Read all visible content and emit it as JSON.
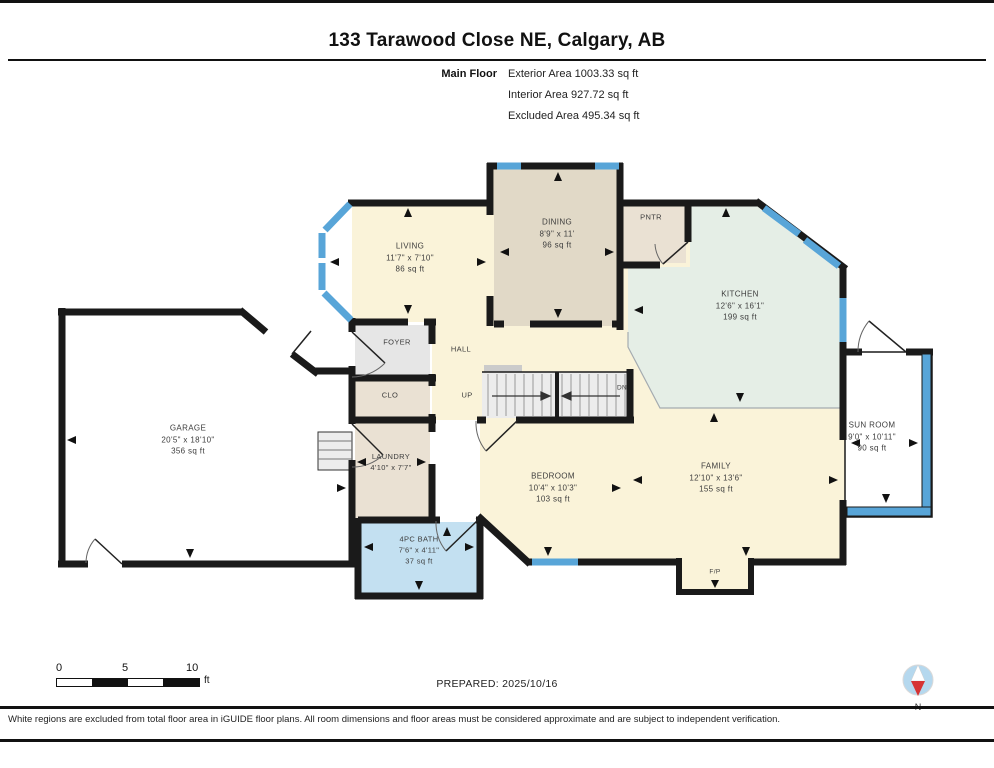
{
  "page": {
    "title": "133 Tarawood Close NE, Calgary, AB",
    "floor_label": "Main Floor",
    "stats": [
      {
        "label": "Exterior Area",
        "value": "1003.33 sq ft"
      },
      {
        "label": "Interior Area",
        "value": "927.72 sq ft"
      },
      {
        "label": "Excluded Area",
        "value": "495.34 sq ft"
      }
    ]
  },
  "rooms": {
    "living": {
      "name": "LIVING",
      "dims": "11'7\" x 7'10\"",
      "area": "86 sq ft"
    },
    "dining": {
      "name": "DINING",
      "dims": "8'9\" x 11'",
      "area": "96 sq ft"
    },
    "pantry": {
      "name": "PNTR"
    },
    "kitchen": {
      "name": "KITCHEN",
      "dims": "12'6\" x 16'1\"",
      "area": "199 sq ft"
    },
    "foyer": {
      "name": "FOYER"
    },
    "hall": {
      "name": "HALL"
    },
    "closet": {
      "name": "CLO"
    },
    "laundry": {
      "name": "LAUNDRY",
      "dims": "4'10\" x 7'7\""
    },
    "garage": {
      "name": "GARAGE",
      "dims": "20'5\" x 18'10\"",
      "area": "356 sq ft"
    },
    "bedroom": {
      "name": "BEDROOM",
      "dims": "10'4\" x 10'3\"",
      "area": "103 sq ft"
    },
    "family": {
      "name": "FAMILY",
      "dims": "12'10\" x 13'6\"",
      "area": "155 sq ft"
    },
    "sunroom": {
      "name": "SUN ROOM",
      "dims": "9'0\" x 10'11\"",
      "area": "90 sq ft"
    },
    "bath": {
      "name": "4PC BATH",
      "dims": "7'6\" x 4'11\"",
      "area": "37 sq ft"
    },
    "fireplace": {
      "name": "F/P"
    },
    "stairs": {
      "up": "UP",
      "down": "DN"
    }
  },
  "footer": {
    "scale_ticks": {
      "t0": "0",
      "t5": "5",
      "t10": "10",
      "unit": "ft"
    },
    "prepared": "PREPARED: 2025/10/16",
    "compass_label": "N",
    "disclaimer": "White regions are excluded from total floor area in iGUIDE floor plans. All room dimensions and floor areas must be considered approximate and are subject to independent verification."
  },
  "colors": {
    "wall": "#1a1a1a",
    "window": "#58a5d8",
    "room_yellow": "#faf3d9",
    "room_tan_dining": "#e1d9c7",
    "room_tan_small": "#eae1d3",
    "room_mint": "#e5eee6",
    "room_gray_foyer": "#e6e6e6",
    "room_blue_bath": "#c3e0f1",
    "excluded_white": "#ffffff",
    "compass_blue": "#b5d8ee",
    "compass_red": "#d63333"
  }
}
